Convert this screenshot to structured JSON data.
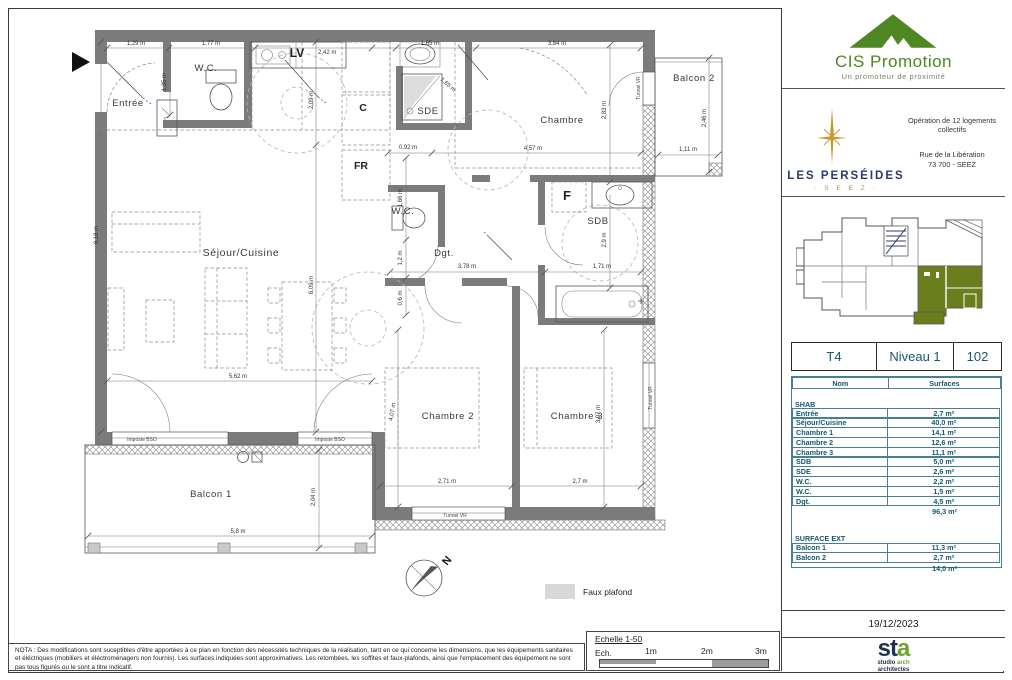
{
  "plan": {
    "rooms": {
      "entree": "Entrée",
      "wc_top": "W.C.",
      "sejour": "Séjour/Cuisine",
      "sde": "SDE",
      "chambre": "Chambre",
      "wc_mid": "W.C.",
      "dgt": "Dgt.",
      "sdb": "SDB",
      "chambre2": "Chambre 2",
      "chambre3": "Chambre 3",
      "balcon1": "Balcon 1",
      "balcon2": "Balcon 2"
    },
    "fixtures": {
      "lv": "LV",
      "c": "C",
      "fr": "FR",
      "f": "F"
    },
    "annotations": {
      "tunnel_vr": "Tunnel VR",
      "imposte_bso": "Imposte BSO",
      "north": "N",
      "legend_faux_plafond": "Faux plafond"
    },
    "dims": {
      "a1": "1,29 m",
      "a2": "1,77 m",
      "a3": "2,42 m",
      "a4": "1,65 m",
      "a5": "3,84 m",
      "a6": "1,35 m",
      "a7": "2,09 m",
      "a8": "1,65 m",
      "a9": "2,83 m",
      "a10": "2,46 m",
      "a11": "1,11 m",
      "a12": "4,57 m",
      "a13": "0,92 m",
      "a14": "1,66 m",
      "a15": "1,2 m",
      "a16": "0,6 m",
      "a17": "6,09 m",
      "a18": "8,18 m",
      "a19": "5,62 m",
      "a20": "3,78 m",
      "a21": "1,71 m",
      "a22": "2,9 m",
      "a23": "4,07 m",
      "a24": "2,71 m",
      "a25": "2,7 m",
      "a26": "3,97 m",
      "a27": "5,8 m",
      "a28": "2,04 m"
    }
  },
  "title_block": {
    "cis": {
      "name": "CIS Promotion",
      "tagline": "Un promoteur de proximité"
    },
    "project": {
      "operation": "Opération de 12 logements collectifs",
      "address_line1": "Rue de la Libération",
      "address_line2": "73 700 - SEEZ",
      "brand": "LES PERSÉIDES",
      "brand_sub": "· S E E Z ·"
    },
    "unit": {
      "type": "T4",
      "level": "Niveau 1",
      "number": "102"
    },
    "table": {
      "headers": [
        "Nom",
        "Surfaces"
      ],
      "sections": [
        {
          "title": "SHAB",
          "rows": [
            [
              "Entrée",
              "2,7 m²"
            ],
            [
              "Séjour/Cuisine",
              "40,0 m²"
            ],
            [
              "Chambre 1",
              "14,1 m²"
            ],
            [
              "Chambre 2",
              "12,6 m²"
            ],
            [
              "Chambre 3",
              "11,1 m²"
            ],
            [
              "SDB",
              "5,0 m²"
            ],
            [
              "SDE",
              "2,6 m²"
            ],
            [
              "W.C.",
              "2,2 m²"
            ],
            [
              "W.C.",
              "1,5 m²"
            ],
            [
              "Dgt.",
              "4,5 m²"
            ]
          ],
          "total": "96,3 m²"
        },
        {
          "title": "SURFACE EXT",
          "rows": [
            [
              "Balcon 1",
              "11,3 m²"
            ],
            [
              "Balcon 2",
              "2,7 m²"
            ]
          ],
          "total": "14,0 m²"
        }
      ]
    },
    "date": "19/12/2023",
    "architect": {
      "logo_st": "st",
      "logo_a": "a",
      "sub1_a": "studio",
      "sub1_b": " arch",
      "sub2": "architectes"
    }
  },
  "footer": {
    "nota": "NOTA : Des modifications sont suceptibles d'être apportées à ce plan en fonction des nécessités techniques de la réalisation, tant en ce qui concerne les dimensions, que les équipements sanitaires et éléctriques (mobiliers et éléctroménagers non fournis). Les surfaces indiquées sont approximatives. Les retombées, les soffites et faux-plafonds, ainsi que l'emplacement des équipement ne sont pas tous figurés ou le sont a titre indicatif.",
    "scale_title": "Echelle 1-50",
    "scale_label": "Ech.",
    "scale_ticks": [
      "1m",
      "2m",
      "3m"
    ]
  }
}
